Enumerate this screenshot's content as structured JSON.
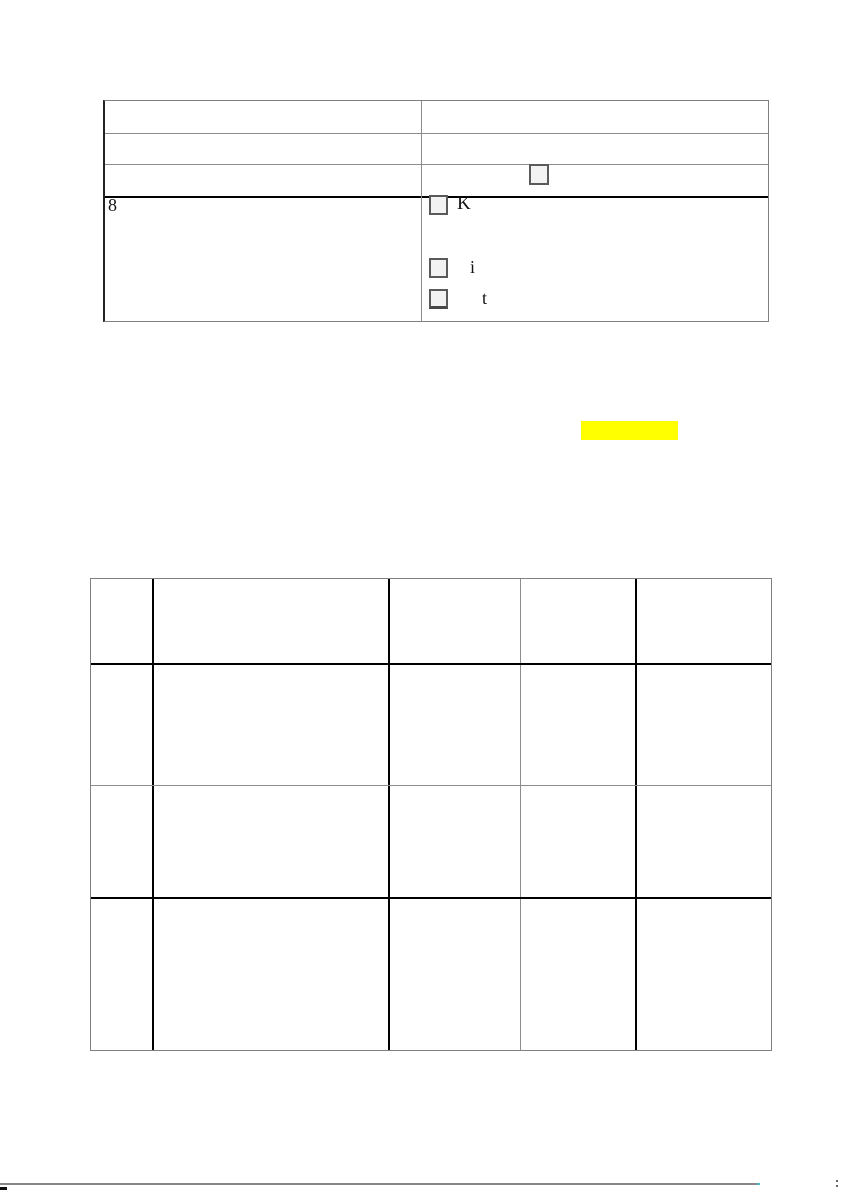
{
  "document": {
    "form_table": {
      "rows_empty": [
        "",
        "",
        ""
      ],
      "unlabeled_checkbox": {
        "checked": false
      },
      "item_number": "8",
      "options": [
        {
          "label": "K",
          "checked": false
        },
        {
          "label": "i",
          "checked": false
        },
        {
          "label": "t",
          "checked": false
        }
      ]
    },
    "highlight": {
      "text": "",
      "color": "#ffff00"
    },
    "grid_table": {
      "columns": 5,
      "rows": 4,
      "content": "empty"
    }
  },
  "colors": {
    "page_background": "#ffffff",
    "rule_gray": "#808080",
    "rule_black": "#000000",
    "checkbox_fill": "#f2f2f2",
    "checkbox_border": "#5a5a5a",
    "highlight_yellow": "#ffff00",
    "bottom_rule_gray": "#878787"
  }
}
